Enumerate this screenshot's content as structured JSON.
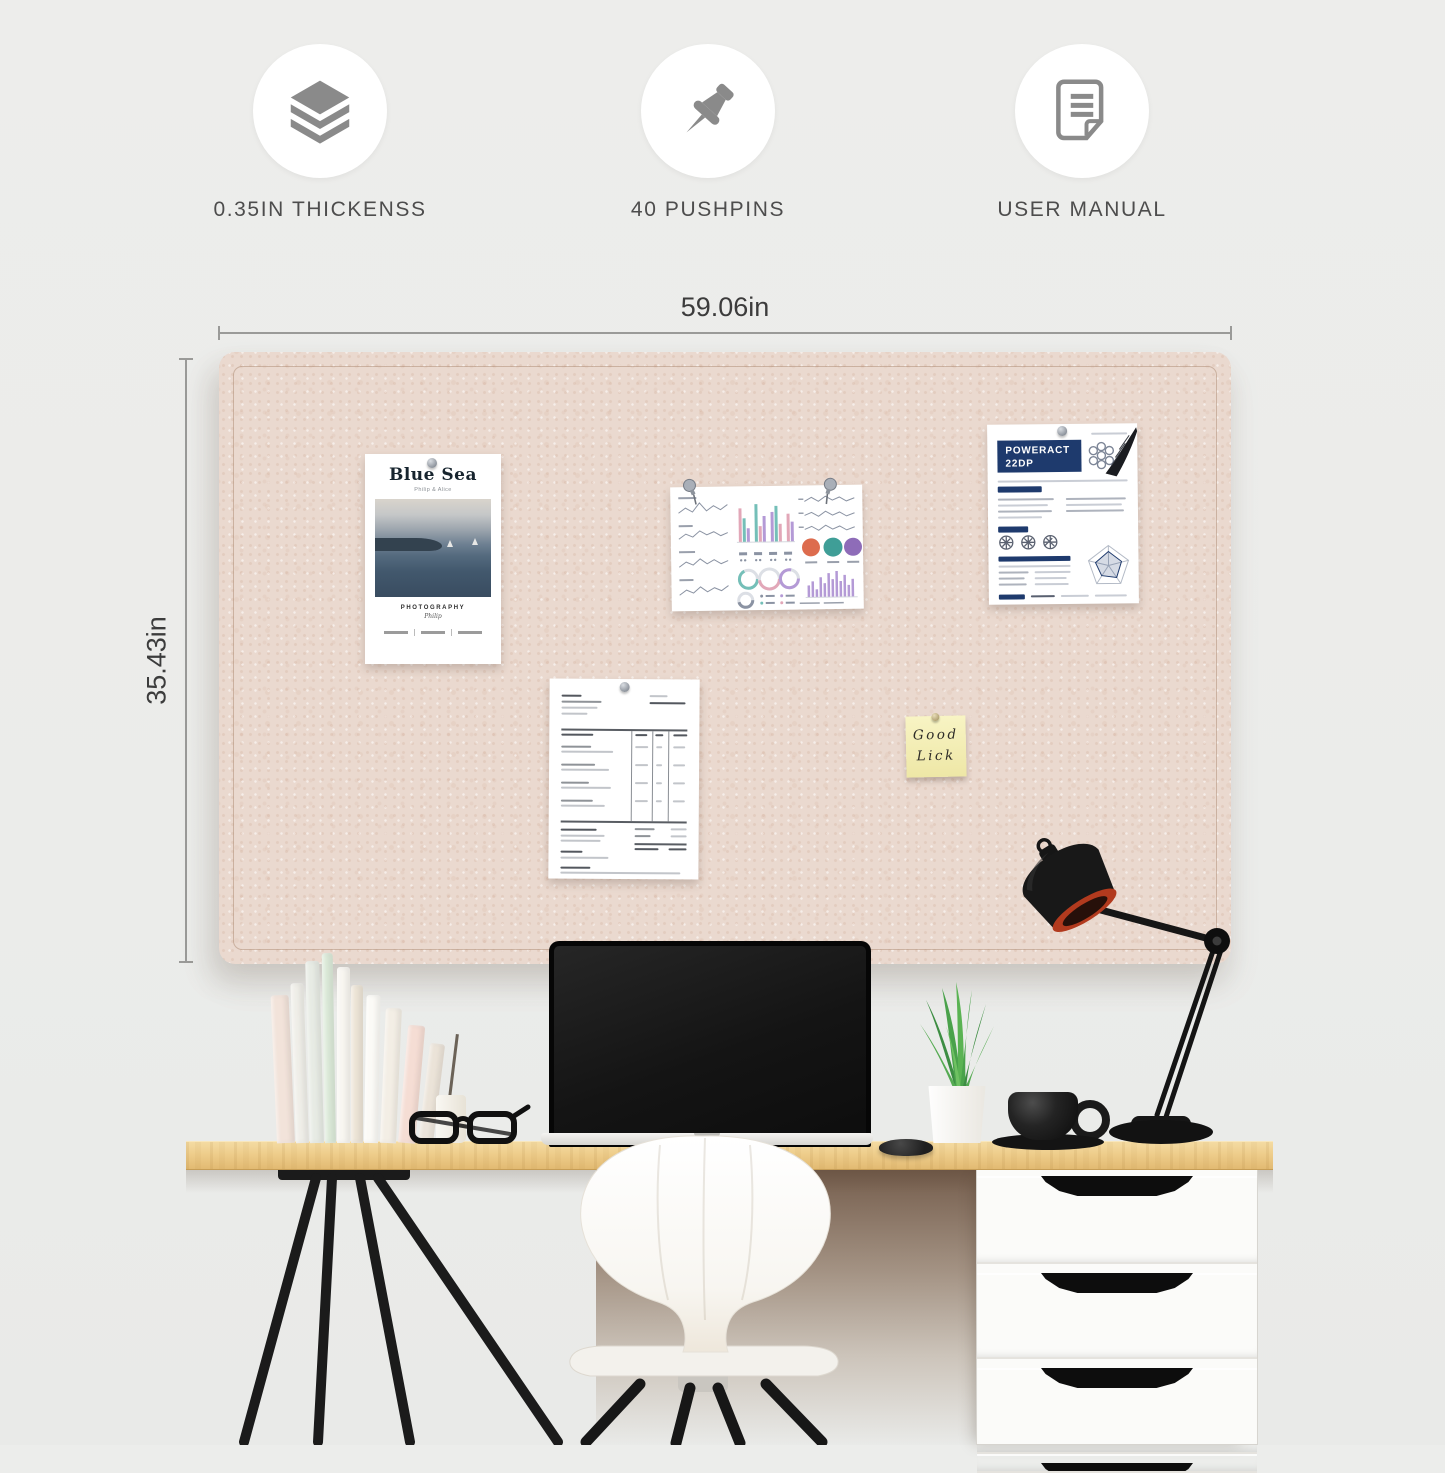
{
  "features": [
    {
      "icon": "layers-icon",
      "label": "0.35IN THICKENSS"
    },
    {
      "icon": "pushpin-icon",
      "label": "40 PUSHPINS"
    },
    {
      "icon": "user-manual-icon",
      "label": "USER MANUAL"
    }
  ],
  "dimensions": {
    "width": "59.06in",
    "height": "35.43in"
  },
  "board": {
    "poster": {
      "title": "Blue Sea",
      "subtitle": "Philip & Alice",
      "caption": "PHOTOGRAPHY",
      "author": "Philip"
    },
    "datasheet": {
      "title_line1": "POWERACT",
      "title_line2": "22DP"
    },
    "sticky_note": {
      "line1": "Good",
      "line2": "Lick"
    }
  },
  "colors": {
    "board_felt": "#EAD9CF",
    "desk_wood": "#EECD8B",
    "datasheet_navy": "#1E3A6D",
    "sticky_yellow": "#F5EFB4",
    "lamp_rim": "#B23A1E"
  }
}
